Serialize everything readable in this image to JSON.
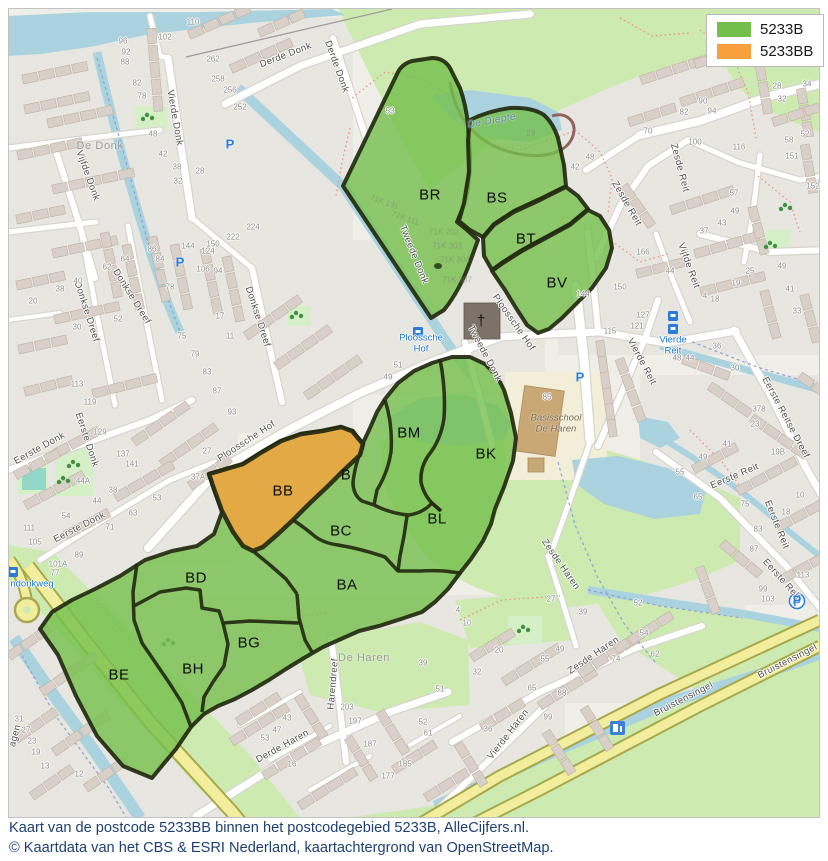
{
  "legend": {
    "items": [
      {
        "label": "5233B",
        "color": "#74bf4c"
      },
      {
        "label": "5233BB",
        "color": "#f8a13c"
      }
    ]
  },
  "caption": {
    "line1": "Kaart van de postcode 5233BB binnen het postcodegebied 5233B, AlleCijfers.nl.",
    "line2": "© Kaartdata van het CBS & ESRI Nederland, kaartachtergrond van OpenStreetMap."
  },
  "colors": {
    "postcode_green": "#74bf4c",
    "postcode_orange": "#f8a13c",
    "region_border": "#232a10",
    "water": "#aad3df",
    "park": "#cdebb0",
    "major_road": "#f2ee9e"
  },
  "map_labels": {
    "regions": [
      {
        "t": "BR",
        "x": 430,
        "y": 196,
        "r": 0
      },
      {
        "t": "BS",
        "x": 497,
        "y": 199,
        "r": 0
      },
      {
        "t": "BT",
        "x": 526,
        "y": 240,
        "r": 0
      },
      {
        "t": "BV",
        "x": 557,
        "y": 284,
        "r": 0
      },
      {
        "t": "BM",
        "x": 409,
        "y": 434,
        "r": 0
      },
      {
        "t": "BK",
        "x": 486,
        "y": 455,
        "r": 0
      },
      {
        "t": "B",
        "x": 346,
        "y": 476,
        "r": 0
      },
      {
        "t": "BB",
        "x": 283,
        "y": 492,
        "r": 0
      },
      {
        "t": "BC",
        "x": 341,
        "y": 532,
        "r": 0
      },
      {
        "t": "BL",
        "x": 437,
        "y": 520,
        "r": 0
      },
      {
        "t": "BA",
        "x": 347,
        "y": 586,
        "r": 0
      },
      {
        "t": "BD",
        "x": 196,
        "y": 579,
        "r": 0
      },
      {
        "t": "BG",
        "x": 249,
        "y": 644,
        "r": 0
      },
      {
        "t": "BH",
        "x": 193,
        "y": 670,
        "r": 0
      },
      {
        "t": "BE",
        "x": 119,
        "y": 676,
        "r": 0
      }
    ],
    "streets": [
      {
        "t": "Derde Donk",
        "x": 286,
        "y": 56,
        "r": -21
      },
      {
        "t": "Derde Donk",
        "x": 336,
        "y": 67,
        "r": 70
      },
      {
        "t": "Vierde Donk",
        "x": 174,
        "y": 118,
        "r": 80
      },
      {
        "t": "Vijfde Donk",
        "x": 87,
        "y": 176,
        "r": 70
      },
      {
        "t": "Donkse Dreef",
        "x": 86,
        "y": 312,
        "r": 72
      },
      {
        "t": "Donkse Dreef",
        "x": 131,
        "y": 297,
        "r": 58
      },
      {
        "t": "Donkse Dreef",
        "x": 257,
        "y": 317,
        "r": 72
      },
      {
        "t": "Tweede Donk",
        "x": 413,
        "y": 255,
        "r": 68
      },
      {
        "t": "Tweede Donk",
        "x": 484,
        "y": 354,
        "r": 62
      },
      {
        "t": "Ploossche Hof",
        "x": 247,
        "y": 442,
        "r": -33
      },
      {
        "t": "Ploossche Hof",
        "x": 513,
        "y": 323,
        "r": 55
      },
      {
        "t": "Eerste Donk",
        "x": 40,
        "y": 449,
        "r": -29
      },
      {
        "t": "Eerste Donk",
        "x": 86,
        "y": 440,
        "r": 72
      },
      {
        "t": "Eerste Donk",
        "x": 80,
        "y": 528,
        "r": -27
      },
      {
        "t": "Eerste Reitse Dreef",
        "x": 785,
        "y": 418,
        "r": 62
      },
      {
        "t": "Eerste Reit",
        "x": 735,
        "y": 477,
        "r": -23
      },
      {
        "t": "Eerste Reit",
        "x": 776,
        "y": 525,
        "r": 68
      },
      {
        "t": "Eerste Reit",
        "x": 781,
        "y": 580,
        "r": 48
      },
      {
        "t": "Vierde Reit",
        "x": 641,
        "y": 362,
        "r": 62
      },
      {
        "t": "Vijfde Reit",
        "x": 688,
        "y": 266,
        "r": 70
      },
      {
        "t": "Zesde Reit",
        "x": 679,
        "y": 168,
        "r": 75
      },
      {
        "t": "Zesde Reit",
        "x": 626,
        "y": 204,
        "r": 60
      },
      {
        "t": "Zesde Haren",
        "x": 560,
        "y": 565,
        "r": 55
      },
      {
        "t": "Zesde Haren",
        "x": 594,
        "y": 656,
        "r": -34
      },
      {
        "t": "Vierde Haren",
        "x": 509,
        "y": 735,
        "r": -52
      },
      {
        "t": "Derde Haren",
        "x": 283,
        "y": 747,
        "r": -29
      },
      {
        "t": "Harendreef",
        "x": 334,
        "y": 684,
        "r": -85
      },
      {
        "t": "Bruistensingel",
        "x": 684,
        "y": 700,
        "r": -27
      },
      {
        "t": "Bruistensingel",
        "x": 788,
        "y": 662,
        "r": -27
      },
      {
        "t": "agen",
        "x": 16,
        "y": 736,
        "r": -75
      }
    ],
    "areas": [
      {
        "t": "De Donk",
        "x": 100,
        "y": 146,
        "r": 0
      },
      {
        "t": "De Haren",
        "x": 364,
        "y": 658,
        "r": 0
      }
    ],
    "water": [
      {
        "t": "De Diepte",
        "x": 492,
        "y": 121,
        "r": -10
      }
    ],
    "blue_pois": [
      {
        "t": "Ploossche\nHof",
        "x": 421,
        "y": 344,
        "r": 0
      },
      {
        "t": "Vierde\nReit",
        "x": 673,
        "y": 346,
        "r": 0
      },
      {
        "t": "ndonkweg",
        "x": 32,
        "y": 585,
        "r": 0
      }
    ],
    "school": [
      {
        "t": "Basisschool\nDe Haren",
        "x": 556,
        "y": 424,
        "r": 0
      }
    ],
    "cadastral": [
      {
        "t": "71K 131",
        "x": 384,
        "y": 203,
        "r": 20
      },
      {
        "t": "71K 111",
        "x": 405,
        "y": 219,
        "r": 20
      },
      {
        "t": "71K 202",
        "x": 444,
        "y": 233,
        "r": 0
      },
      {
        "t": "71K 303",
        "x": 447,
        "y": 247,
        "r": 0
      },
      {
        "t": "71K 304",
        "x": 455,
        "y": 261,
        "r": 0
      },
      {
        "t": "71K 307",
        "x": 457,
        "y": 281,
        "r": 0
      },
      {
        "t": "29",
        "x": 531,
        "y": 134,
        "r": 0
      }
    ],
    "house_numbers": [
      {
        "t": "96",
        "x": 123,
        "y": 42
      },
      {
        "t": "92",
        "x": 126,
        "y": 53
      },
      {
        "t": "88",
        "x": 125,
        "y": 63
      },
      {
        "t": "82",
        "x": 137,
        "y": 84
      },
      {
        "t": "78",
        "x": 142,
        "y": 97
      },
      {
        "t": "102",
        "x": 165,
        "y": 38
      },
      {
        "t": "110",
        "x": 193,
        "y": 23
      },
      {
        "t": "262",
        "x": 213,
        "y": 60
      },
      {
        "t": "258",
        "x": 218,
        "y": 80
      },
      {
        "t": "256",
        "x": 230,
        "y": 91
      },
      {
        "t": "252",
        "x": 240,
        "y": 108
      },
      {
        "t": "48",
        "x": 153,
        "y": 135
      },
      {
        "t": "42",
        "x": 163,
        "y": 155
      },
      {
        "t": "38",
        "x": 177,
        "y": 168
      },
      {
        "t": "32",
        "x": 178,
        "y": 182
      },
      {
        "t": "28",
        "x": 200,
        "y": 172
      },
      {
        "t": "224",
        "x": 253,
        "y": 228
      },
      {
        "t": "150",
        "x": 213,
        "y": 245
      },
      {
        "t": "222",
        "x": 233,
        "y": 238
      },
      {
        "t": "144",
        "x": 188,
        "y": 247
      },
      {
        "t": "124",
        "x": 208,
        "y": 252
      },
      {
        "t": "106",
        "x": 203,
        "y": 270
      },
      {
        "t": "94",
        "x": 218,
        "y": 272
      },
      {
        "t": "86",
        "x": 152,
        "y": 250
      },
      {
        "t": "84",
        "x": 160,
        "y": 260
      },
      {
        "t": "78",
        "x": 170,
        "y": 288
      },
      {
        "t": "62",
        "x": 107,
        "y": 268
      },
      {
        "t": "64",
        "x": 125,
        "y": 260
      },
      {
        "t": "40",
        "x": 78,
        "y": 282
      },
      {
        "t": "38",
        "x": 60,
        "y": 290
      },
      {
        "t": "20",
        "x": 33,
        "y": 302
      },
      {
        "t": "30",
        "x": 77,
        "y": 328
      },
      {
        "t": "52",
        "x": 118,
        "y": 320
      },
      {
        "t": "75",
        "x": 182,
        "y": 337
      },
      {
        "t": "79",
        "x": 195,
        "y": 355
      },
      {
        "t": "83",
        "x": 207,
        "y": 373
      },
      {
        "t": "87",
        "x": 217,
        "y": 392
      },
      {
        "t": "93",
        "x": 232,
        "y": 413
      },
      {
        "t": "113",
        "x": 77,
        "y": 385
      },
      {
        "t": "119",
        "x": 90,
        "y": 403
      },
      {
        "t": "129",
        "x": 100,
        "y": 433
      },
      {
        "t": "137",
        "x": 123,
        "y": 455
      },
      {
        "t": "141",
        "x": 132,
        "y": 465
      },
      {
        "t": "17",
        "x": 220,
        "y": 317
      },
      {
        "t": "11",
        "x": 230,
        "y": 337
      },
      {
        "t": "27",
        "x": 207,
        "y": 452
      },
      {
        "t": "37A",
        "x": 198,
        "y": 478
      },
      {
        "t": "44A",
        "x": 83,
        "y": 482
      },
      {
        "t": "38",
        "x": 113,
        "y": 491
      },
      {
        "t": "44",
        "x": 97,
        "y": 502
      },
      {
        "t": "54",
        "x": 66,
        "y": 517
      },
      {
        "t": "63",
        "x": 133,
        "y": 514
      },
      {
        "t": "71",
        "x": 110,
        "y": 528
      },
      {
        "t": "111",
        "x": 29,
        "y": 529
      },
      {
        "t": "105",
        "x": 35,
        "y": 543
      },
      {
        "t": "89",
        "x": 79,
        "y": 556
      },
      {
        "t": "101A",
        "x": 58,
        "y": 565
      },
      {
        "t": "77",
        "x": 55,
        "y": 574
      },
      {
        "t": "53",
        "x": 157,
        "y": 499
      },
      {
        "t": "90",
        "x": 703,
        "y": 102
      },
      {
        "t": "94",
        "x": 712,
        "y": 112
      },
      {
        "t": "82",
        "x": 684,
        "y": 113
      },
      {
        "t": "70",
        "x": 648,
        "y": 132
      },
      {
        "t": "100",
        "x": 695,
        "y": 143
      },
      {
        "t": "116",
        "x": 739,
        "y": 148
      },
      {
        "t": "151",
        "x": 792,
        "y": 157
      },
      {
        "t": "57",
        "x": 734,
        "y": 194
      },
      {
        "t": "49",
        "x": 735,
        "y": 212
      },
      {
        "t": "43",
        "x": 722,
        "y": 224
      },
      {
        "t": "37",
        "x": 704,
        "y": 232
      },
      {
        "t": "25",
        "x": 750,
        "y": 272
      },
      {
        "t": "19",
        "x": 736,
        "y": 284
      },
      {
        "t": "28",
        "x": 777,
        "y": 87
      },
      {
        "t": "32",
        "x": 782,
        "y": 100
      },
      {
        "t": "34",
        "x": 807,
        "y": 85
      },
      {
        "t": "58",
        "x": 789,
        "y": 141
      },
      {
        "t": "52",
        "x": 805,
        "y": 135
      },
      {
        "t": "152",
        "x": 813,
        "y": 187
      },
      {
        "t": "49",
        "x": 782,
        "y": 267
      },
      {
        "t": "41",
        "x": 790,
        "y": 290
      },
      {
        "t": "33",
        "x": 797,
        "y": 312
      },
      {
        "t": "378",
        "x": 759,
        "y": 410
      },
      {
        "t": "23",
        "x": 755,
        "y": 425
      },
      {
        "t": "19B",
        "x": 778,
        "y": 453
      },
      {
        "t": "10",
        "x": 800,
        "y": 496
      },
      {
        "t": "18",
        "x": 786,
        "y": 513
      },
      {
        "t": "83",
        "x": 758,
        "y": 530
      },
      {
        "t": "87",
        "x": 754,
        "y": 550
      },
      {
        "t": "113",
        "x": 803,
        "y": 576
      },
      {
        "t": "99",
        "x": 763,
        "y": 590
      },
      {
        "t": "103",
        "x": 768,
        "y": 600
      },
      {
        "t": "36",
        "x": 717,
        "y": 347
      },
      {
        "t": "30",
        "x": 735,
        "y": 369
      },
      {
        "t": "48",
        "x": 677,
        "y": 359
      },
      {
        "t": "44",
        "x": 690,
        "y": 359
      },
      {
        "t": "41",
        "x": 727,
        "y": 445
      },
      {
        "t": "49",
        "x": 703,
        "y": 458
      },
      {
        "t": "55",
        "x": 680,
        "y": 473
      },
      {
        "t": "65",
        "x": 698,
        "y": 498
      },
      {
        "t": "75",
        "x": 745,
        "y": 505
      },
      {
        "t": "115",
        "x": 610,
        "y": 332
      },
      {
        "t": "85",
        "x": 547,
        "y": 398
      },
      {
        "t": "144",
        "x": 583,
        "y": 295
      },
      {
        "t": "51",
        "x": 398,
        "y": 366
      },
      {
        "t": "49",
        "x": 388,
        "y": 378
      },
      {
        "t": "20",
        "x": 499,
        "y": 651
      },
      {
        "t": "32",
        "x": 477,
        "y": 673
      },
      {
        "t": "55",
        "x": 545,
        "y": 660
      },
      {
        "t": "49",
        "x": 560,
        "y": 650
      },
      {
        "t": "65",
        "x": 532,
        "y": 689
      },
      {
        "t": "88",
        "x": 562,
        "y": 694
      },
      {
        "t": "99",
        "x": 548,
        "y": 718
      },
      {
        "t": "36",
        "x": 488,
        "y": 730
      },
      {
        "t": "54",
        "x": 644,
        "y": 634
      },
      {
        "t": "62",
        "x": 655,
        "y": 655
      },
      {
        "t": "74",
        "x": 616,
        "y": 660
      },
      {
        "t": "52",
        "x": 638,
        "y": 604
      },
      {
        "t": "39",
        "x": 583,
        "y": 613
      },
      {
        "t": "27",
        "x": 551,
        "y": 600
      },
      {
        "t": "10",
        "x": 467,
        "y": 624
      },
      {
        "t": "4",
        "x": 458,
        "y": 611
      },
      {
        "t": "203",
        "x": 347,
        "y": 708
      },
      {
        "t": "197",
        "x": 355,
        "y": 722
      },
      {
        "t": "187",
        "x": 370,
        "y": 745
      },
      {
        "t": "185",
        "x": 405,
        "y": 765
      },
      {
        "t": "177",
        "x": 388,
        "y": 777
      },
      {
        "t": "43",
        "x": 287,
        "y": 719
      },
      {
        "t": "47",
        "x": 277,
        "y": 731
      },
      {
        "t": "53",
        "x": 265,
        "y": 739
      },
      {
        "t": "16",
        "x": 292,
        "y": 765
      },
      {
        "t": "39",
        "x": 423,
        "y": 664
      },
      {
        "t": "51",
        "x": 440,
        "y": 690
      },
      {
        "t": "52",
        "x": 423,
        "y": 723
      },
      {
        "t": "61",
        "x": 428,
        "y": 734
      },
      {
        "t": "31",
        "x": 19,
        "y": 720
      },
      {
        "t": "27",
        "x": 26,
        "y": 731
      },
      {
        "t": "23",
        "x": 32,
        "y": 742
      },
      {
        "t": "19",
        "x": 36,
        "y": 753
      },
      {
        "t": "13",
        "x": 45,
        "y": 767
      },
      {
        "t": "12",
        "x": 79,
        "y": 775
      },
      {
        "t": "53",
        "x": 390,
        "y": 112
      },
      {
        "t": "48",
        "x": 590,
        "y": 158
      },
      {
        "t": "42",
        "x": 575,
        "y": 168
      },
      {
        "t": "166",
        "x": 643,
        "y": 253
      },
      {
        "t": "150",
        "x": 620,
        "y": 288
      },
      {
        "t": "127",
        "x": 643,
        "y": 316
      },
      {
        "t": "121",
        "x": 637,
        "y": 327
      },
      {
        "t": "44",
        "x": 670,
        "y": 272
      },
      {
        "t": "4",
        "x": 705,
        "y": 297
      },
      {
        "t": "18",
        "x": 715,
        "y": 300
      }
    ]
  },
  "icons": {
    "parking_glyph": "P",
    "parking": [
      {
        "x": 230,
        "y": 145
      },
      {
        "x": 180,
        "y": 263
      },
      {
        "x": 580,
        "y": 378
      },
      {
        "x": 797,
        "y": 601
      }
    ],
    "church_symbol": "†",
    "church": {
      "x": 481,
      "y": 322
    }
  }
}
